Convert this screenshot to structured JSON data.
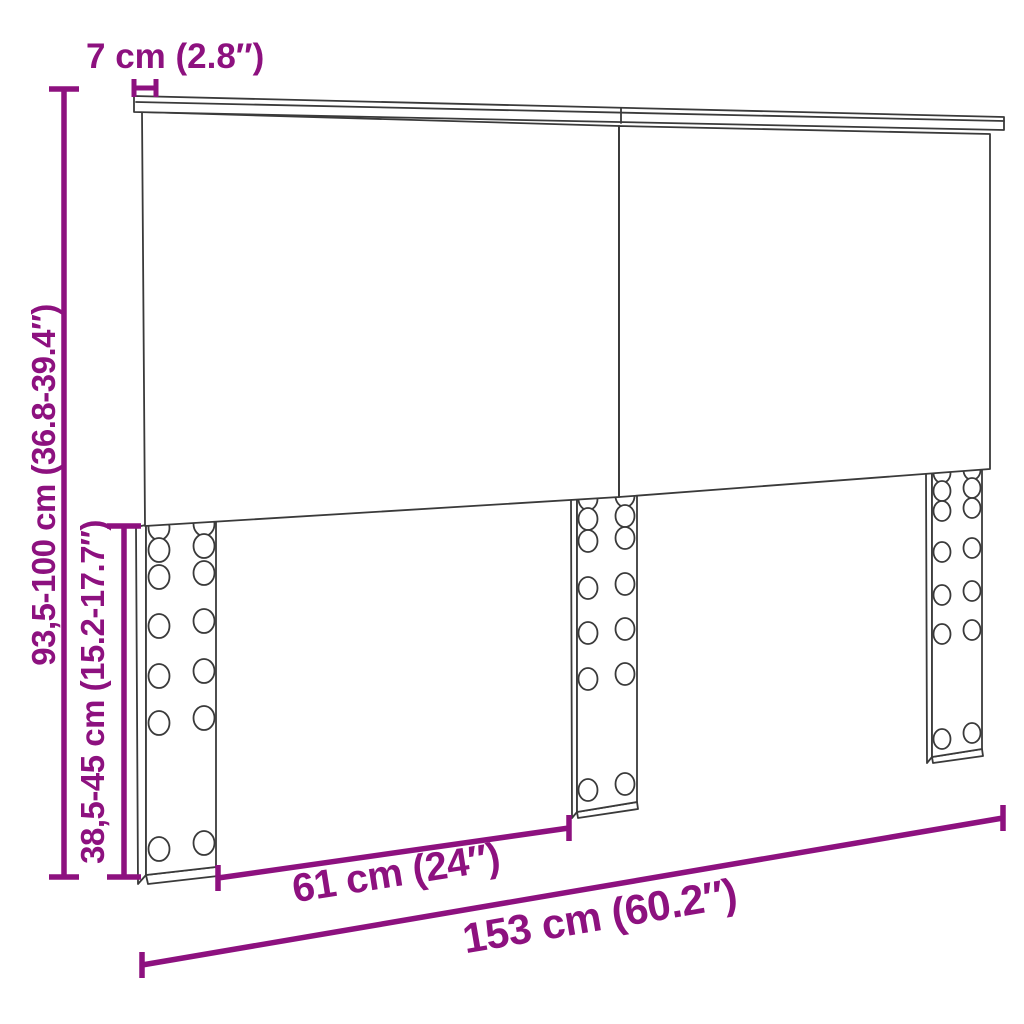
{
  "page": {
    "background": "#ffffff"
  },
  "diagram": {
    "product": "headboard",
    "view": "perspective-line-drawing",
    "style": {
      "dimension_color": "#8d117f",
      "outline_color": "#3a3a3a"
    },
    "parts": {
      "top_rail": "top rail board",
      "panel_left": "left headboard panel",
      "panel_right": "right headboard panel",
      "leg_left": "left leg with adjustment holes",
      "leg_middle": "middle leg with adjustment holes",
      "leg_right": "right leg with adjustment holes"
    },
    "dimensions": {
      "top_rail_thickness": {
        "label": "7 cm (2.8″)"
      },
      "total_height": {
        "label": "93,5-100 cm (36.8-39.4″)"
      },
      "leg_height": {
        "label": "38,5-45 cm (15.2-17.7″)"
      },
      "leg_spacing": {
        "label": "61 cm (24″)"
      },
      "total_width": {
        "label": "153 cm (60.2″)"
      }
    }
  }
}
